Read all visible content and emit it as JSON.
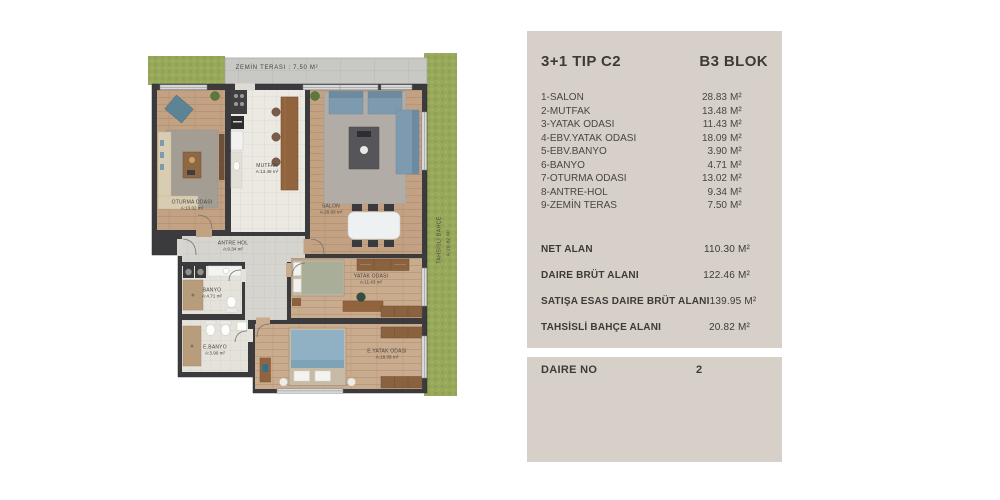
{
  "plan": {
    "terrace_label": "ZEMİN TERASI : 7,50 M²",
    "garden_line1": "TAHSİSLİ BAHÇE",
    "garden_line2": "A:20.82 M²",
    "rooms": [
      {
        "name": "OTURMA ODASI",
        "area": "A:13.02 m²"
      },
      {
        "name": "MUTFAK",
        "area": "A:13.48 m²"
      },
      {
        "name": "SALON",
        "area": "A:28.83 m²"
      },
      {
        "name": "ANTRE HOL",
        "area": "A:9.34 m²"
      },
      {
        "name": "BANYO",
        "area": "A:4.71 m²"
      },
      {
        "name": "E.BANYO",
        "area": "A:3.90 m²"
      },
      {
        "name": "YATAK ODASI",
        "area": "A:11.43 m²"
      },
      {
        "name": "E.YATAK ODASI",
        "area": "A:18.09 m²"
      }
    ]
  },
  "panel": {
    "title": "3+1 TIP C2",
    "block": "B3 BLOK",
    "rows": [
      {
        "label": "1-SALON",
        "num": "28.83",
        "unit": "M²"
      },
      {
        "label": "2-MUTFAK",
        "num": "13.48",
        "unit": "M²"
      },
      {
        "label": "3-YATAK ODASI",
        "num": "11.43",
        "unit": "M²"
      },
      {
        "label": "4-EBV.YATAK ODASI",
        "num": "18.09",
        "unit": "M²"
      },
      {
        "label": "5-EBV.BANYO",
        "num": "3.90",
        "unit": "M²"
      },
      {
        "label": "6-BANYO",
        "num": "4.71",
        "unit": "M²"
      },
      {
        "label": "7-OTURMA ODASI",
        "num": "13.02",
        "unit": "M²"
      },
      {
        "label": "8-ANTRE-HOL",
        "num": "9.34",
        "unit": "M²"
      },
      {
        "label": "9-ZEMİN TERAS",
        "num": "7.50",
        "unit": "M²"
      }
    ],
    "summary": [
      {
        "label": "NET ALAN",
        "num": "110.30",
        "unit": "M²"
      },
      {
        "label": "DAIRE BRÜT ALANI",
        "num": "122.46",
        "unit": "M²"
      },
      {
        "label": "SATIŞA ESAS DAIRE BRÜT ALANI",
        "num": "139.95",
        "unit": "M²"
      },
      {
        "label": "TAHSİSLİ BAHÇE ALANI",
        "num": "20.82",
        "unit": "M²"
      }
    ]
  },
  "unit_panel": {
    "label": "DAIRE NO",
    "value": "2"
  },
  "colors": {
    "panel_bg": "#d6d0c9",
    "text_dark": "#3e3a36",
    "grass": "#98a95b",
    "wall": "#3b3b3d",
    "wood_floor": "#c3a284",
    "bedroom_floor": "#c9ab8d",
    "kitchen_tile": "#ebe9e2",
    "terrace": "#c8c8c4",
    "sofa_blue": "#7e9aae"
  }
}
